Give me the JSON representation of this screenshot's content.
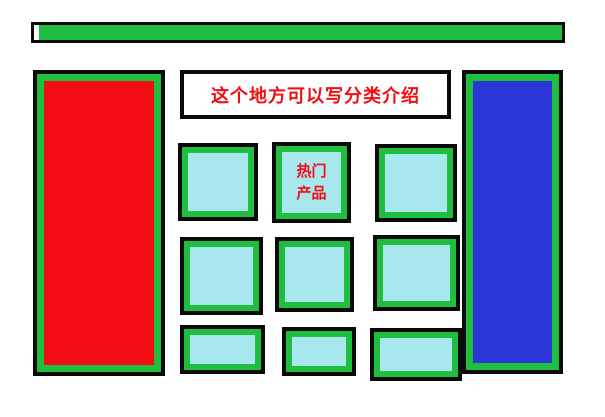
{
  "colors": {
    "green": "#1FBE3E",
    "red": "#F20D13",
    "blue": "#2B36D9",
    "cyan": "#A9E7EE",
    "black": "#0A0A0A",
    "label_red": "#F20D13"
  },
  "intro_box": {
    "text": "这个地方可以写分类介绍"
  },
  "hot_product_box": {
    "line1": "热门",
    "line2": "产品"
  }
}
